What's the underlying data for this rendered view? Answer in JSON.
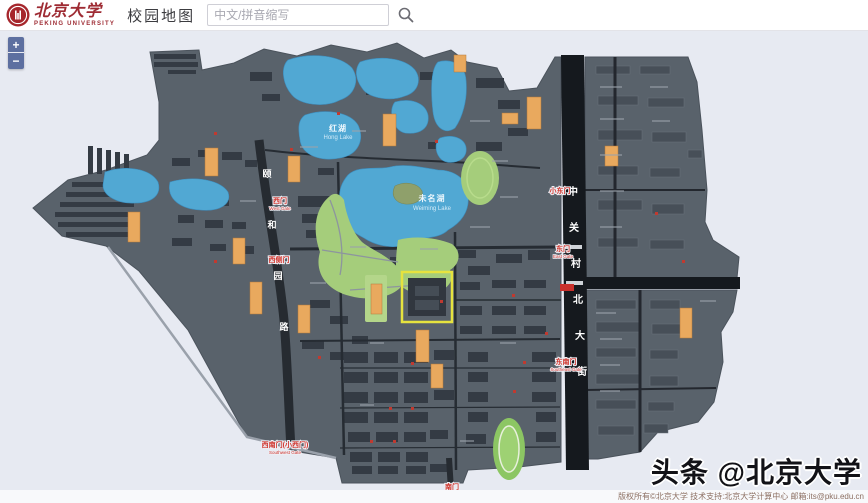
{
  "header": {
    "logo": {
      "seal_text": "北大",
      "cn": "北京大学",
      "en": "PEKING UNIVERSITY"
    },
    "title": "校园地图",
    "search": {
      "placeholder": "中文/拼音缩写",
      "icon": "search-magnifier"
    }
  },
  "map_controls": {
    "zoom_in": "+",
    "zoom_out": "−"
  },
  "map": {
    "streets": {
      "right": {
        "name": "中关村北大街",
        "chars": [
          "中",
          "关",
          "村",
          "北",
          "大",
          "街"
        ]
      },
      "left": {
        "name": "颐和园路",
        "chars": [
          "颐",
          "和",
          "园",
          "路"
        ]
      }
    },
    "water": {
      "weiming": {
        "cn": "未名湖",
        "en": "Weiming Lake"
      },
      "hong": {
        "cn": "红湖",
        "en": "Hong Lake"
      }
    },
    "gates": {
      "west": {
        "cn": "西门",
        "en": "West Gate"
      },
      "west_side": {
        "cn": "西侧门",
        "en": ""
      },
      "southwest": {
        "cn": "西南门(小西门)",
        "en": "Southwest Gate"
      },
      "south": {
        "cn": "南门",
        "en": ""
      },
      "small_east": {
        "cn": "小东门",
        "en": ""
      },
      "east": {
        "cn": "东门",
        "en": "East Gate"
      },
      "southeast": {
        "cn": "东南门",
        "en": "Southeast Gate"
      }
    }
  },
  "watermark": "头条 @北京大学",
  "footer": {
    "text": "版权所有©北京大学 技术支持:北京大学计算中心 邮箱:its@pku.edu.cn"
  },
  "colors": {
    "brand_red": "#9e2b33",
    "map_background": "#e7eaf2",
    "campus_gray": "#59626b",
    "building_dark": "#343b44",
    "road_black": "#15191e",
    "water_blue": "#51a8d3",
    "green_area": "#a5cd7b",
    "poi_label_orange": "#e9a95e",
    "gate_red": "#d0342c",
    "selection_yellow": "#e6e33f"
  }
}
